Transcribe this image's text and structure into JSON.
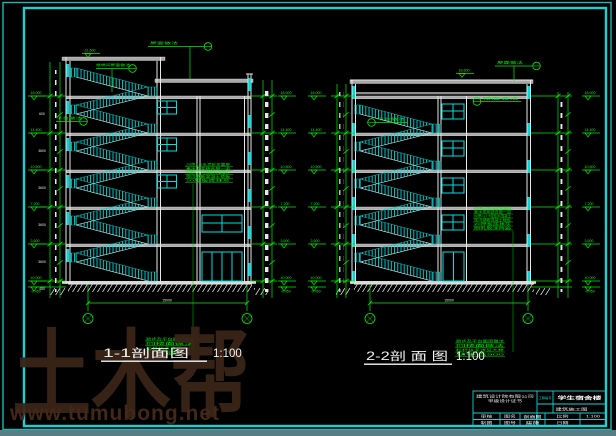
{
  "sheet": {
    "kind": "cad-section-drawing-sheet",
    "background": "#000000",
    "frame_color": "#1ad0d0",
    "taskbar_color": "#577e84"
  },
  "watermark": {
    "brand": "土木帮",
    "site": "www.tumubong.net",
    "color": "#3a2417"
  },
  "elevations": [
    "18.000",
    "14.400",
    "10.800",
    "7.200",
    "3.600",
    "±0.000"
  ],
  "elevation_neg": "-0.450",
  "chain_dims": [
    "600",
    "3600",
    "3600",
    "3600",
    "3600",
    "450"
  ],
  "sections": [
    {
      "title": "1-1剖面图",
      "scale": "1:100",
      "top_elevation": "21.600",
      "total_dim": "15000",
      "callouts": {
        "roof": "屋面做法",
        "stair_roof": "楼梯间屋面做法",
        "landing": "平台做法"
      },
      "notes": [
        "20厚1:2水泥砂浆面层",
        "素水泥浆结合层一道",
        "60厚CL7.5轻集料混凝土",
        "现浇钢筋混凝土楼板",
        "20厚板底抹灰"
      ],
      "footnotes": [
        "踏步及平台面层做法",
        "同楼面做法",
        "栏杆扶手详见大样",
        "扶手高900"
      ]
    },
    {
      "title": "2-2剖 面 图",
      "scale": "1:100",
      "top_elevation": "18.600",
      "total_dim": "15000",
      "callouts": {
        "roof": "屋面做法",
        "floor": "楼面做法",
        "landing": "平台做法"
      },
      "notes": [
        "20厚1:2水泥砂浆面层",
        "素水泥浆结合层一道",
        "60厚CL7.5轻集料混凝土",
        "现浇钢筋混凝土楼板",
        "20厚板底抹灰",
        "刷乳胶漆两遍"
      ],
      "footnotes": [
        "踏步及平台面层做法",
        "同楼面做法",
        "栏杆扶手详见大样",
        "扶手高900"
      ]
    }
  ],
  "title_block": {
    "org": "建筑设计院有限公司",
    "org_sub": "甲级设计证书",
    "project_no_label": "工程编号",
    "project_name": "学生宿舍楼",
    "stage": "建筑施工图",
    "shen_he": "审核",
    "zhi_tu": "制图",
    "tu_ming": "图名",
    "tu_hao": "图号",
    "drawing_name": "剖面图",
    "drawing_no": "建施",
    "bi_li": "比例",
    "ri_qi": "日期",
    "scale_value": "1:100"
  }
}
